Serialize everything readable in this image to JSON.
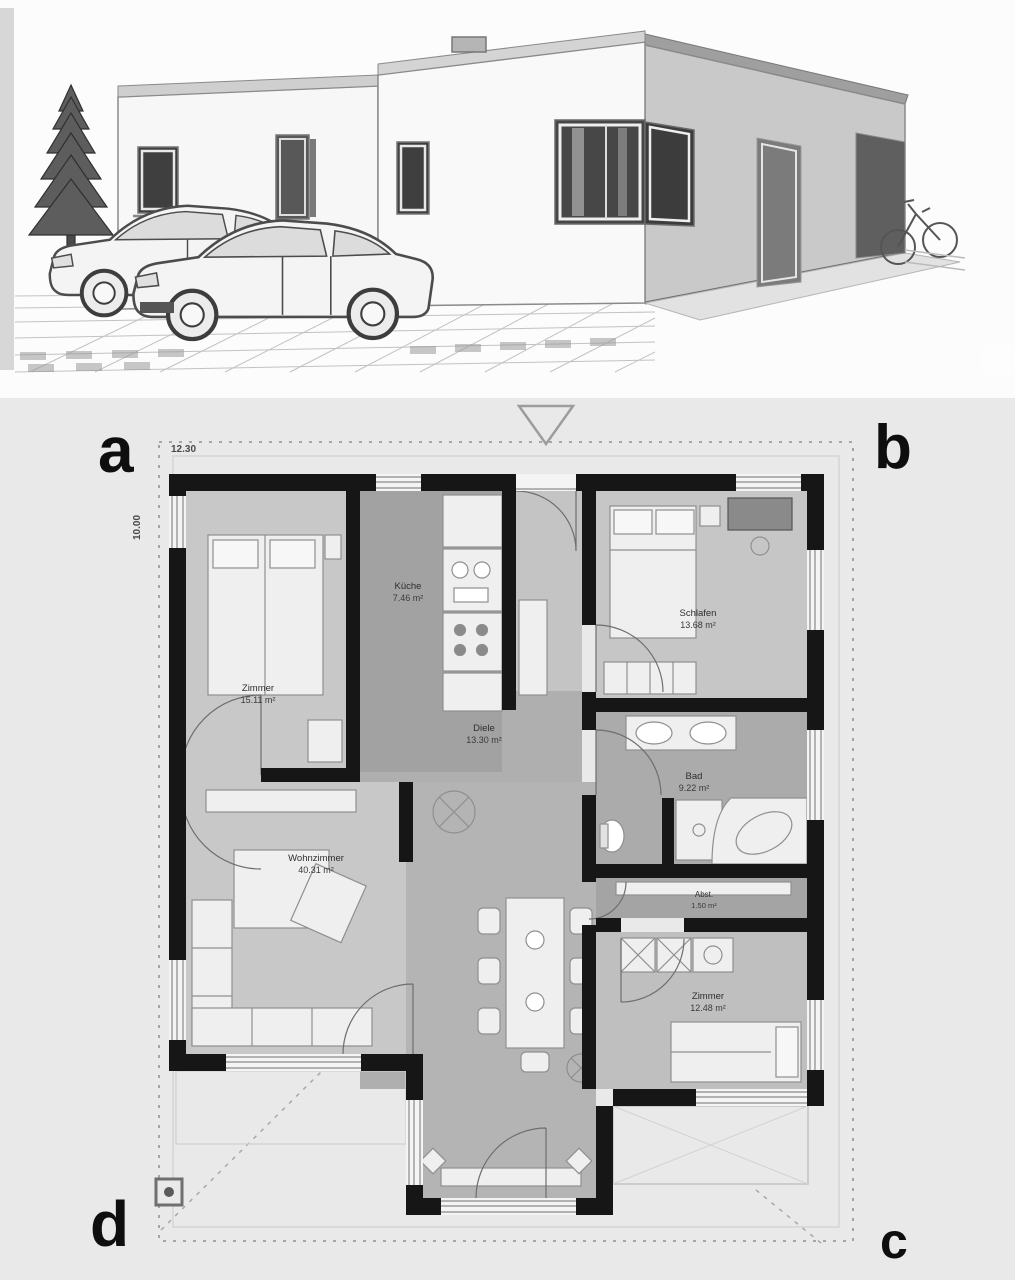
{
  "plan": {
    "corner_labels": {
      "top_left": "a",
      "top_right": "b",
      "bottom_right": "c",
      "bottom_left": "d"
    },
    "dimensions": {
      "width": "12.30",
      "depth": "10.00"
    },
    "rooms": {
      "zimmer1": {
        "label": "Zimmer",
        "area": "15.11 m²"
      },
      "kueche": {
        "label": "Küche",
        "area": "7.46 m²"
      },
      "schlafen": {
        "label": "Schlafen",
        "area": "13.68 m²"
      },
      "diele": {
        "label": "Diele",
        "area": "13.30 m²"
      },
      "bad": {
        "label": "Bad",
        "area": "9.22 m²"
      },
      "abstell": {
        "label": "Abst.",
        "area": "1.50 m²"
      },
      "zimmer2": {
        "label": "Zimmer",
        "area": "12.48 m²"
      },
      "wohnzimmer": {
        "label": "Wohnzimmer",
        "area": "40.31 m²"
      }
    }
  },
  "colors": {
    "plan_background": "#e9e9e9",
    "wall": "#161616",
    "room_light": "#c8c8c8",
    "room_medium": "#b0b0b0",
    "room_dark": "#a2a2a2",
    "furniture": "#efefef",
    "facade_side": "#c9c9c9",
    "window_glass": "#474747"
  }
}
